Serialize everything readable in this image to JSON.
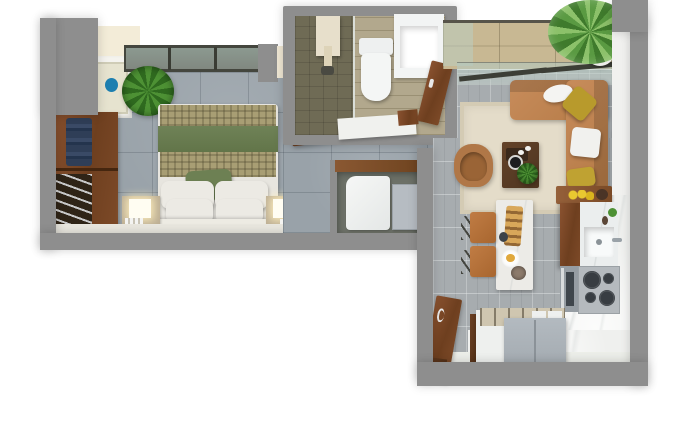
{
  "scene": {
    "type": "3d-floor-plan-render",
    "description": "Top-down 3D render of a studio apartment floor plan on a white background",
    "background_color": "#ffffff",
    "text_visible": false
  },
  "palette": {
    "wall_gray": "#8e8e8e",
    "bedroom_tile": "#99a2a9",
    "living_tile": "#a7acaf",
    "kitchen_marble": "#eff0ee",
    "balcony_wood": "#c8b893",
    "bathroom_wood": "#b2a88d",
    "shower_floor": "#6f6b55",
    "cabinet_wood": "#7a4827",
    "sofa_caramel": "#c08453",
    "accent_olive": "#b89a2c",
    "rug_beige": "#ded6c2",
    "bed_green": "#687c51",
    "bed_plaid_tan": "#a89e74",
    "artwork_orange": "#e07a19",
    "appliance_gray": "#a9b0b6",
    "linen_white": "#eceae4",
    "plant_green": "#4d9134",
    "picture_blue": "#1d7fb0"
  },
  "rooms": {
    "bedroom": {
      "label": "Bedroom",
      "furniture": [
        "wardrobe with folded clothes and hanging rail",
        "double bed with plaid and green throw",
        "green accent pillow",
        "four white pillows",
        "two nightstands with lamps",
        "framed picture with blue artwork",
        "potted plant",
        "full-width window"
      ]
    },
    "bathroom": {
      "label": "Bathroom",
      "furniture": [
        "walk-in shower with glass divider",
        "toilet",
        "square basin vanity",
        "white counter",
        "wooden doors"
      ]
    },
    "laundry_niche": {
      "label": "Laundry niche",
      "furniture": [
        "washing machine",
        "gray utility panel",
        "wood trim"
      ]
    },
    "living_room": {
      "label": "Living room",
      "furniture": [
        "caramel L-shaped sofa",
        "olive and white cushions",
        "white decor bowl",
        "dark wood coffee table with tray and plant",
        "round armchair",
        "beige rug",
        "orange wall art"
      ]
    },
    "dining": {
      "label": "Dining area",
      "furniture": [
        "white marble table",
        "bread board with pastries",
        "plate and bowl",
        "two tan chairs"
      ]
    },
    "kitchen": {
      "label": "Kitchen",
      "furniture": [
        "sideboard with lemons",
        "marble counter with sink and faucet",
        "four-burner cooktop",
        "oven",
        "gray refrigerator island",
        "open wooden entry door"
      ]
    },
    "balcony": {
      "label": "Balcony",
      "furniture": [
        "wood deck",
        "glass railing",
        "large potted tropical plant"
      ]
    }
  }
}
